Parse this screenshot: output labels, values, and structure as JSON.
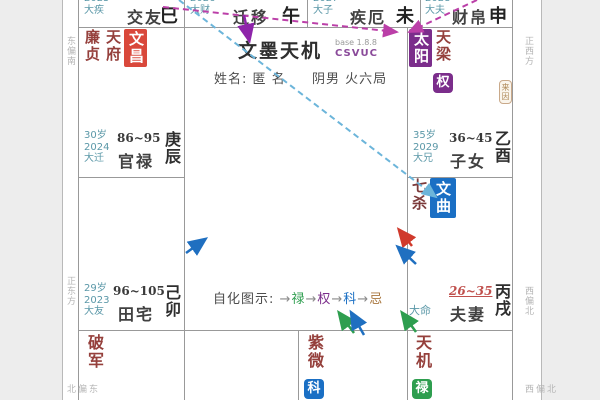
{
  "app": {
    "title": "文墨天机",
    "title_sup": "base 1.8.8",
    "title_sub": "CSVUC"
  },
  "profile": {
    "name_label": "姓名:",
    "name": "匿 名",
    "gender": "阴男",
    "bureau": "火六局"
  },
  "legend": {
    "label": "自化图示:",
    "items": [
      {
        "arrow": "→",
        "name": "禄"
      },
      {
        "arrow": "→",
        "name": "权"
      },
      {
        "arrow": "→",
        "name": "科"
      },
      {
        "arrow": "→",
        "name": "忌"
      }
    ]
  },
  "directions": {
    "left_top": "东偏南",
    "left_middle": "正东方",
    "left_bottom": "东偏北",
    "right_top": "正西方",
    "right_middle": "西偏北",
    "right_bottom": "北偏西"
  },
  "palaces": {
    "si": {
      "year": "2025",
      "da_limit": "大疾",
      "name": "交友",
      "branch": "巳"
    },
    "wu": {
      "year": "2026",
      "da_limit": "大财",
      "name": "迁移",
      "branch": "午"
    },
    "wei": {
      "year": "2027",
      "da_limit": "大子",
      "name": "疾厄",
      "branch": "未"
    },
    "shen": {
      "year": "2028",
      "da_limit": "大夫",
      "name": "财帛",
      "branch": "申"
    },
    "chen": {
      "age": "30岁",
      "year": "2024",
      "da_limit": "大迁",
      "age_range": "86~95",
      "name": "官禄",
      "stem_branch": "庚辰",
      "stars": {
        "s1": "廉贞",
        "s2": "天府",
        "s3": "文昌"
      }
    },
    "you": {
      "age": "35岁",
      "year": "2029",
      "da_limit": "大兄",
      "age_range": "36~45",
      "name": "子女",
      "stem_branch": "乙酉",
      "stars": {
        "s1": "太阳",
        "s2": "天梁"
      },
      "hua": "权",
      "tag": "来因"
    },
    "mao": {
      "age": "29岁",
      "year": "2023",
      "da_limit": "大友",
      "age_range": "96~105",
      "name": "田宅",
      "stem_branch": "己卯"
    },
    "xu": {
      "age_range": "26~35",
      "da_limit": "大命",
      "name": "夫妻",
      "stem_branch": "丙戌",
      "stars": {
        "s1": "七杀",
        "s2": "文曲"
      }
    },
    "yin": {
      "stars": {
        "s1": "破军"
      }
    },
    "zi": {
      "stars": {
        "s1": "紫微"
      },
      "hua": "科"
    },
    "hai": {
      "stars": {
        "s1": "天机"
      },
      "hua": "禄"
    }
  },
  "colors": {
    "star_text": "#95403c",
    "star_box_red": "#d9483b",
    "star_box_purple": "#7b2d8b",
    "star_box_blue": "#1a6fc4",
    "hua_green": "#2e9e4f",
    "label_teal": "#5b98a8",
    "current_range_red": "#c0504d",
    "line_magenta": "#bb3fa8",
    "line_cyan": "#6cb5da",
    "arrow_purple": "#8e24aa",
    "arrow_blue": "#1f6fc0",
    "arrow_red": "#d03a2c",
    "arrow_green": "#2e9e4f"
  }
}
